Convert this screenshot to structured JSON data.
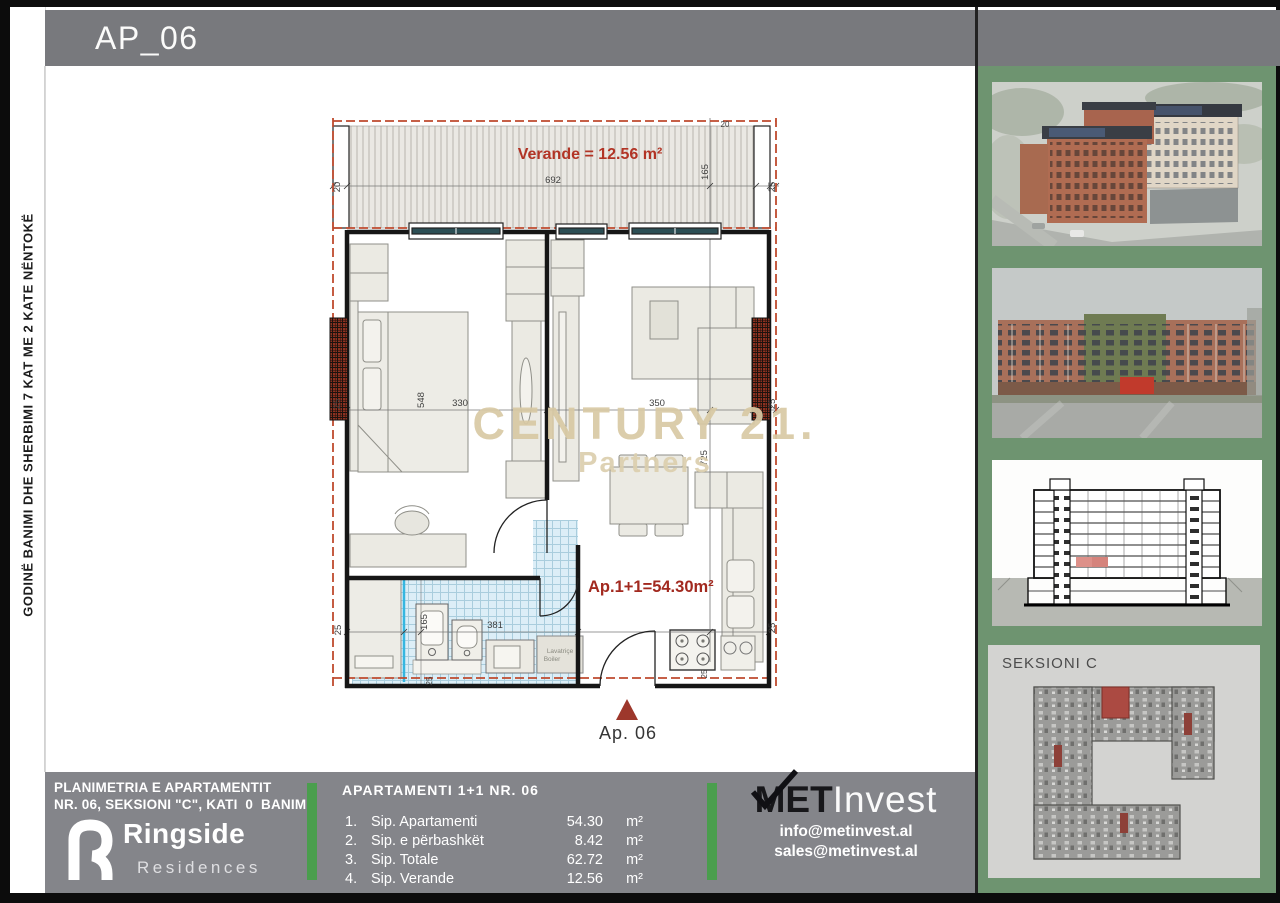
{
  "header": {
    "title": "AP_06"
  },
  "left_sidebar": {
    "vertical_text": "GODINË BANIMI DHE SHERBIMI 7 KAT ME 2 KATE NËNTOKË"
  },
  "watermark": {
    "line1": "CENTURY 21.",
    "line2": "Partners"
  },
  "plan": {
    "veranda_label": "Verande = 12.56 m²",
    "apartment_label": "Ap.1+1=54.30m²",
    "marker_label": "Ap. 06",
    "washer_line1": "Lavatriçe",
    "washer_line2": "Boiler",
    "dims": {
      "veranda_side_left": "20",
      "veranda_width": "692",
      "veranda_side_right": "25",
      "veranda_depth": "165",
      "veranda_top": "20",
      "wall_left": "25",
      "bed_length": "548",
      "bedroom_width": "330",
      "living_width": "350",
      "wall_right": "25",
      "living_depth": "725",
      "bath_depth": "165",
      "bath_width": "381",
      "wall_left_lower": "25",
      "wall_right_lower": "25",
      "bottom_a": "25",
      "bottom_b": "25"
    }
  },
  "right_sidebar": {
    "section_label": "SEKSIONI C"
  },
  "footer": {
    "left": {
      "line1": "PLANIMETRIA E APARTAMENTIT",
      "line2": "NR. 06, SEKSIONI \"C\", KATI  0  BANIM",
      "brand": "Ringside",
      "brand_sub": "Residences"
    },
    "table": {
      "title": "APARTAMENTI 1+1 NR. 06",
      "rows": [
        {
          "num": "1.",
          "label": "Sip. Apartamenti",
          "value": "54.30",
          "unit": "m²"
        },
        {
          "num": "2.",
          "label": "Sip. e përbashkët",
          "value": "8.42",
          "unit": "m²"
        },
        {
          "num": "3.",
          "label": "Sip. Totale",
          "value": "62.72",
          "unit": "m²"
        },
        {
          "num": "4.",
          "label": "Sip. Verande",
          "value": "12.56",
          "unit": "m²"
        }
      ]
    },
    "contact": {
      "brand_bold": "MET",
      "brand_light": "Invest",
      "email1": "info@metinvest.al",
      "email2": "sales@metinvest.al"
    }
  },
  "colors": {
    "header_gray": "#78797d",
    "footer_gray": "#84858a",
    "sidebar_green": "#6e9470",
    "accent_green": "#4a9e4d",
    "plan_red": "#a2291f",
    "dashed_red": "#bf4a2e",
    "watermark_gold": "#d8c9a4",
    "tile_blue": "#dceef7"
  }
}
